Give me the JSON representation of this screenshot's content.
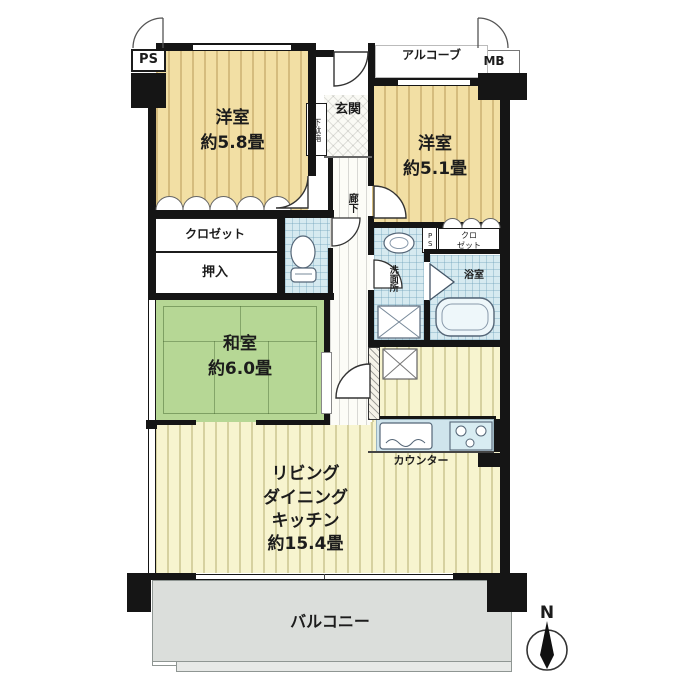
{
  "plan": {
    "type": "apartment-floor-plan",
    "colors": {
      "wall": "#151515",
      "western-room-floor": "#f2dfa4",
      "tatami": "#b6d795",
      "ldk-floor": "#f7f4cf",
      "wet-area": "#d6eaf0",
      "balcony": "#dbdedb"
    },
    "labels": {
      "ps": "PS",
      "alcove": "アルコーブ",
      "mb": "MB",
      "room58": "洋室\n約5.8畳",
      "room51": "洋室\n約5.1畳",
      "getabako": "下駄箱",
      "genkan": "玄関",
      "rouka": "廊下",
      "closet_left": "クロゼット",
      "oshiire": "押入",
      "ps_small": "PS",
      "closet_right": "クロ\nゼット",
      "senmenjo": "洗面所",
      "yokushitsu": "浴室",
      "washitsu": "和室\n約6.0畳",
      "counter": "カウンター",
      "ldk": "リビング\nダイニング\nキッチン\n約15.4畳",
      "balcony": "バルコニー",
      "north": "N"
    }
  }
}
